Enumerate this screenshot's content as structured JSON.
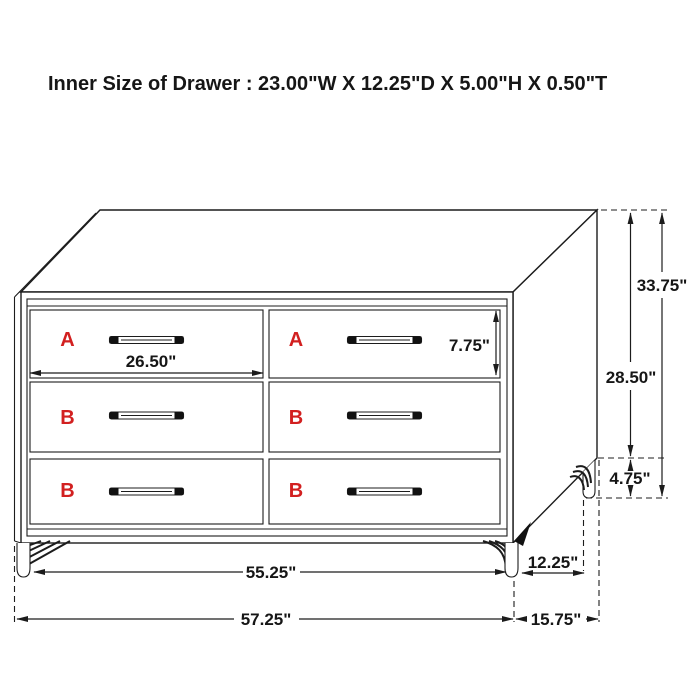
{
  "title": "Inner Size of Drawer : 23.00\"W X 12.25\"D X 5.00\"H X 0.50\"T",
  "colors": {
    "line": "#1c1c1c",
    "label_red": "#d22020",
    "background": "#ffffff"
  },
  "drawer_labels": {
    "row1": [
      "A",
      "A"
    ],
    "row2": [
      "B",
      "B"
    ],
    "row3": [
      "B",
      "B"
    ]
  },
  "dimensions": {
    "drawer_width": "26.50\"",
    "drawer_height": "7.75\"",
    "total_height": "33.75\"",
    "case_height": "28.50\"",
    "leg_height": "4.75\"",
    "base_width": "55.25\"",
    "overall_width": "57.25\"",
    "base_depth": "12.25\"",
    "overall_depth": "15.75\""
  }
}
